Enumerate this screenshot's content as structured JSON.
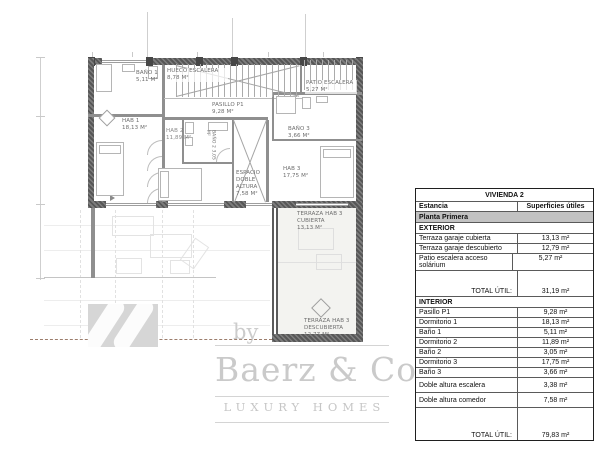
{
  "meta": {
    "type": "architectural floor plan sheet",
    "colors": {
      "wall": "#5a5a5a",
      "watermark": "#c9c9c9",
      "table_band": "#c2c2c2"
    }
  },
  "plan": {
    "rooms": [
      {
        "name": "HUECO ESCALERA",
        "area": "8,78 m²"
      },
      {
        "name": "PASILLO P1",
        "area": "9,28 m²"
      },
      {
        "name": "BAÑO 1",
        "area": "5,11 m²"
      },
      {
        "name": "HAB 1",
        "area": "18,13 m²"
      },
      {
        "name": "BAÑO 2",
        "area": "3,05 m²"
      },
      {
        "name": "HAB 2",
        "area": "11,89 m²"
      },
      {
        "name": "ESPACIO DOBLE ALTURA",
        "area": "7,58 m²"
      },
      {
        "name": "BAÑO 3",
        "area": "3,66 m²"
      },
      {
        "name": "HAB 3",
        "area": "17,75 m²"
      },
      {
        "name": "PATIO ESCALERA",
        "area": "5,27 m²"
      },
      {
        "name": "TERRAZA HAB 3 CUBIERTA",
        "area": "13,13 m²"
      },
      {
        "name": "TERRAZA HAB 3 DESCUBIERTA",
        "area": "12,77 m²"
      }
    ]
  },
  "table": {
    "title": "VIVIENDA 2",
    "col1": "Estancia",
    "col2": "Superficies útiles",
    "floor": "Planta Primera",
    "sections": [
      {
        "name": "EXTERIOR",
        "rows": [
          [
            "Terraza garaje cubierta",
            "13,13 m²"
          ],
          [
            "Terraza garaje descubierto",
            "12,79 m²"
          ],
          [
            "Patio escalera acceso solárium",
            "5,27 m²"
          ]
        ],
        "total_label": "TOTAL ÚTIL:",
        "total": "31,19 m²"
      },
      {
        "name": "INTERIOR",
        "rows": [
          [
            "Pasillo P1",
            "9,28 m²"
          ],
          [
            "Dormitorio 1",
            "18,13 m²"
          ],
          [
            "Baño 1",
            "5,11 m²"
          ],
          [
            "Dormitorio 2",
            "11,89 m²"
          ],
          [
            "Baño 2",
            "3,05 m²"
          ],
          [
            "Dormitorio 3",
            "17,75 m²"
          ],
          [
            "Baño 3",
            "3,66 m²"
          ],
          [
            "Doble altura escalera",
            "3,38 m²"
          ],
          [
            "Doble altura comedor",
            "7,58 m²"
          ]
        ],
        "total_label": "TOTAL ÚTIL:",
        "total": "79,83 m²"
      }
    ]
  },
  "watermark": {
    "by": "by",
    "brand": "Baerz & Co",
    "tagline": "LUXURY HOMES"
  }
}
